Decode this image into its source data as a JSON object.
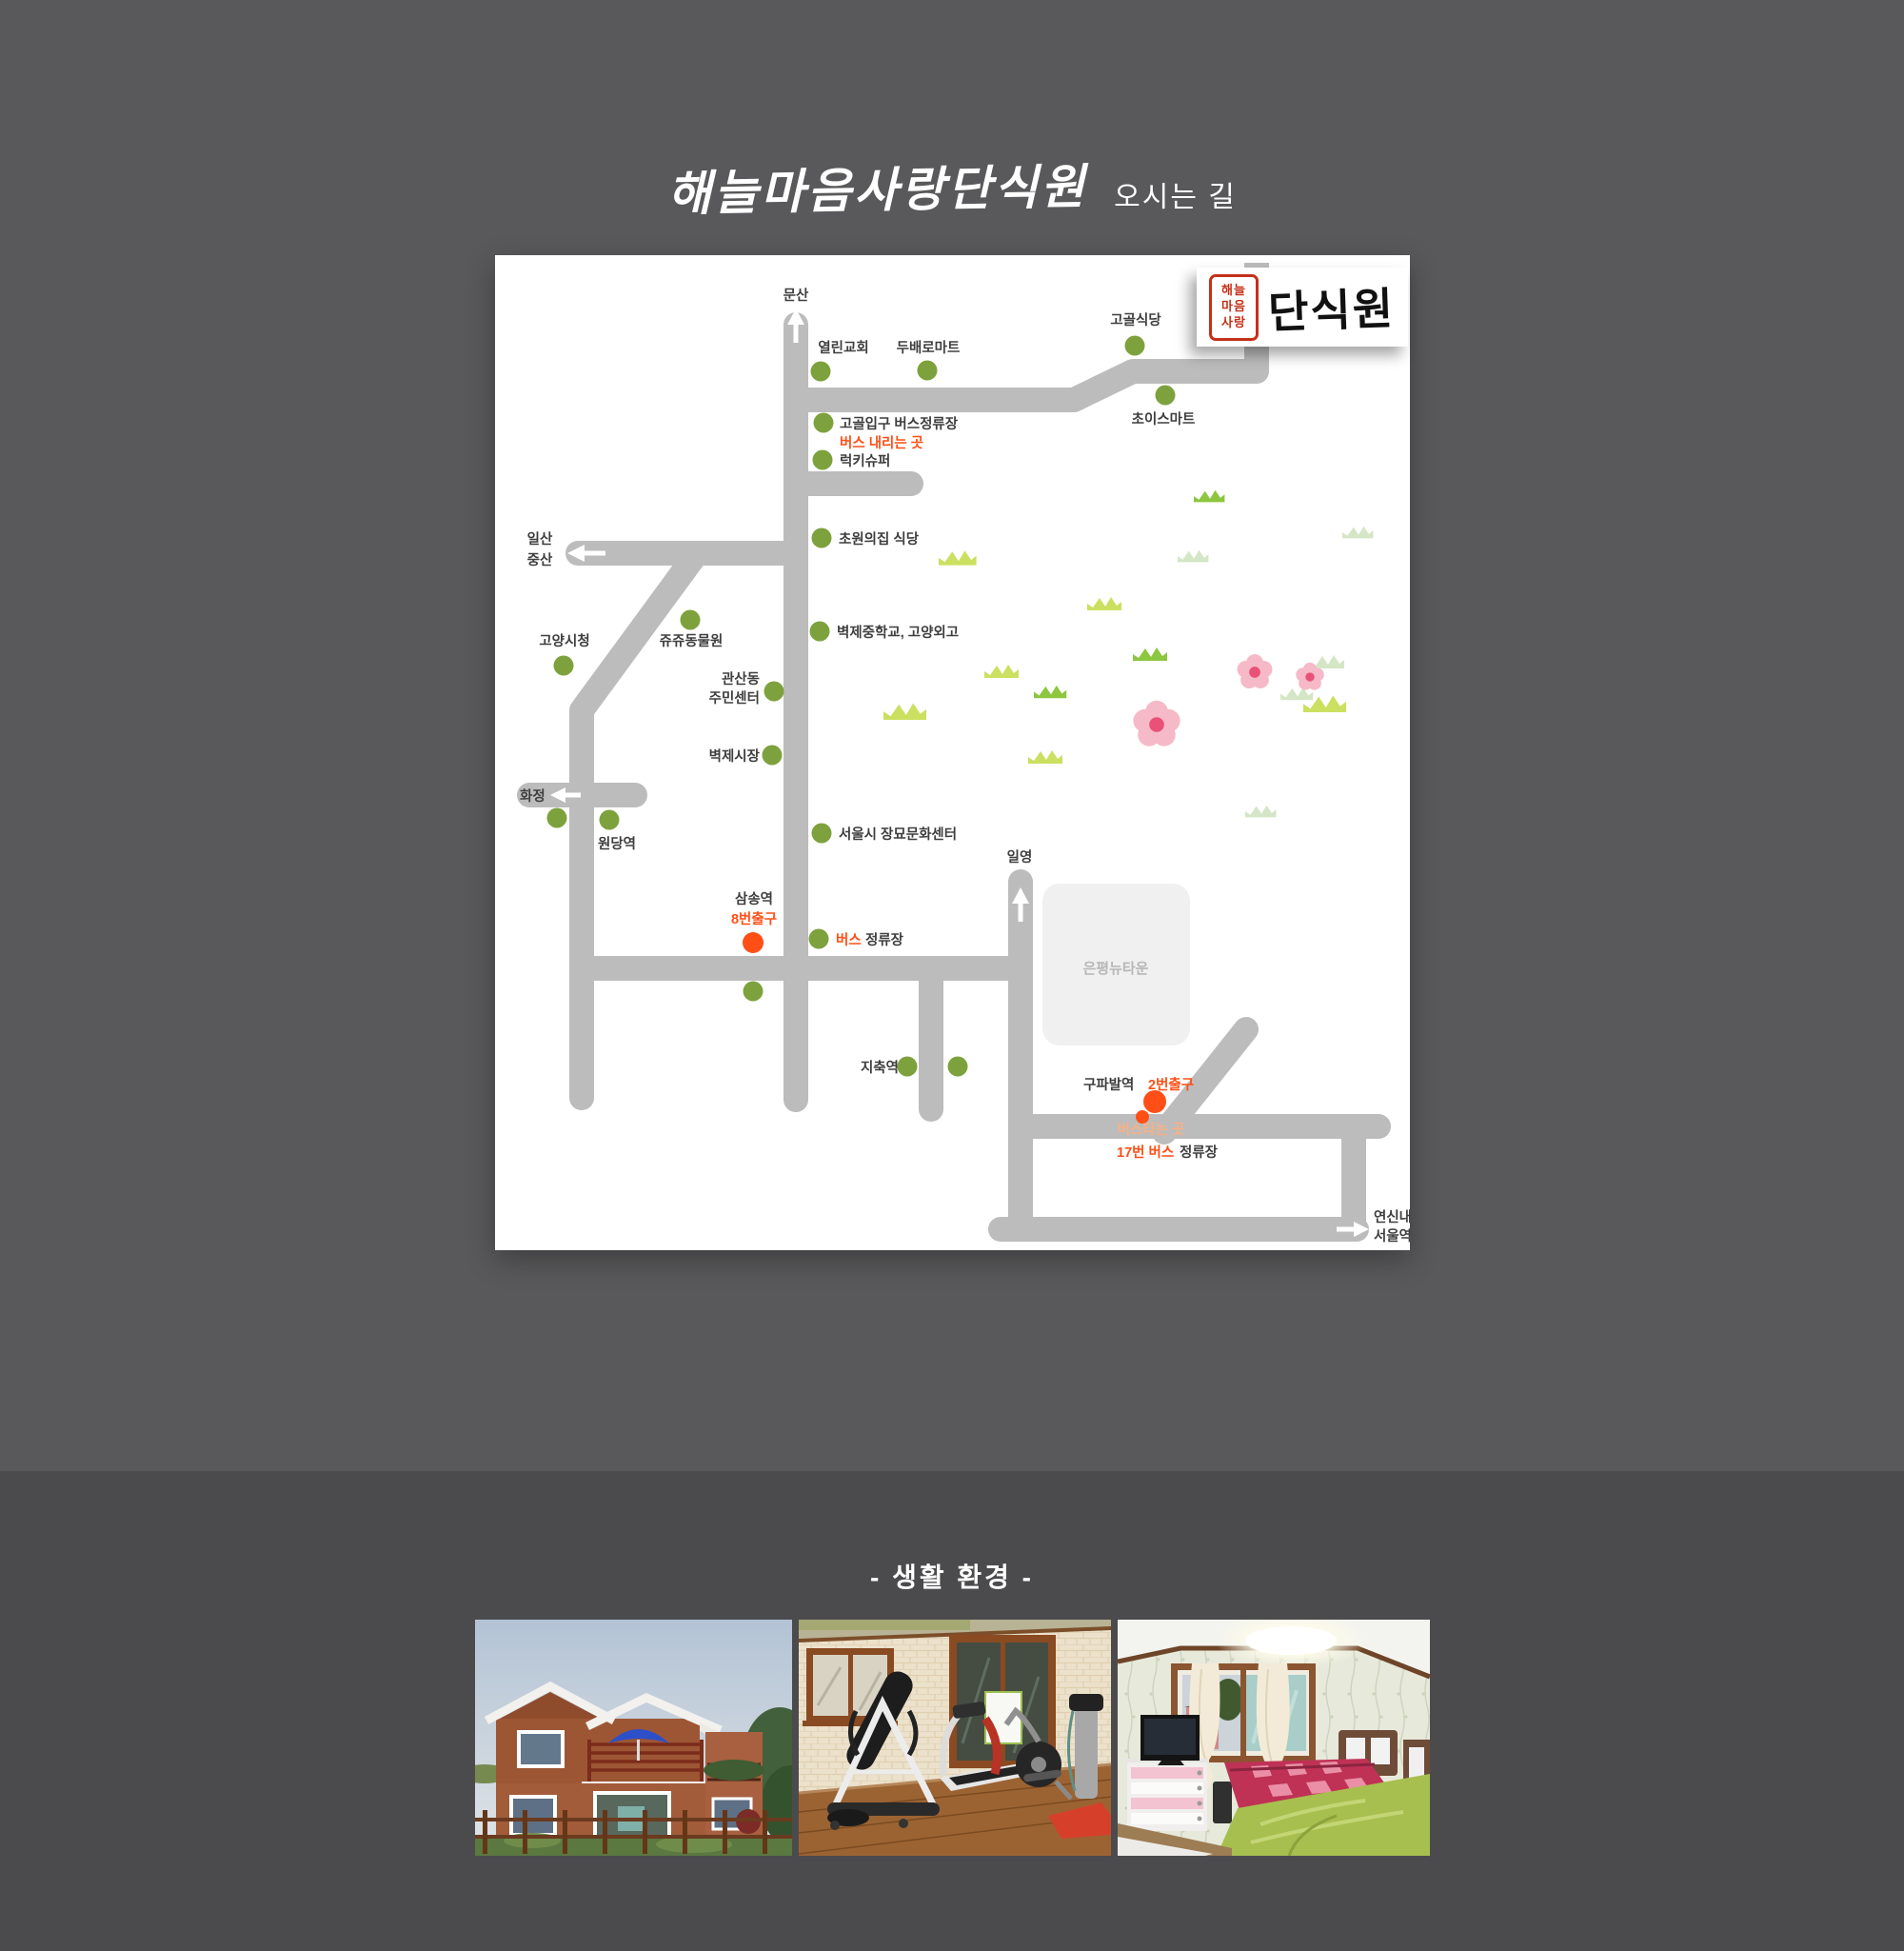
{
  "page": {
    "title": "해늘마음사랑단식원",
    "subtitle": "오시는 길",
    "section_title": "- 생활 환경 -"
  },
  "logo": {
    "seal_line1": "해늘",
    "seal_line2": "마음",
    "seal_line3": "사랑",
    "name": "단식원"
  },
  "map": {
    "labels": {
      "munsan": "문산",
      "yeollin_church": "열린교회",
      "dubae_mart": "두배로마트",
      "gogol_sikdang": "고골식당",
      "choice_mart": "초이스마트",
      "gogol_bus_stop": "고골입구 버스정류장",
      "bus_alight": "버스 내리는 곳",
      "lucky_super": "럭키슈퍼",
      "chowon_sikdang": "초원의집 식당",
      "ilsan": "일산",
      "jungsan": "중산",
      "goyang_cityhall": "고양시청",
      "juju_zoo": "쥬쥬동물원",
      "gwansandong_line1": "관산동",
      "gwansandong_line2": "주민센터",
      "byeokje_school": "벽제중학교, 고양외고",
      "byeokje_market": "벽제시장",
      "hwajeong": "화정",
      "wondang_station": "원당역",
      "jangmyo_center": "서울시 장묘문화센터",
      "samsong_station": "삼송역",
      "samsong_exit": "8번출구",
      "bus_word": "버스",
      "jeongryujang": "정류장",
      "ilyeong": "일영",
      "eunpyeong_newtown": "은평뉴타운",
      "jichuk_station": "지축역",
      "gupabal_station": "구파발역",
      "gupabal_exit": "2번출구",
      "bus_board": "버스타는 곳",
      "bus17": "17번 버스",
      "jeongryujang2": "정류장",
      "yeonsinnae": "연신내",
      "seoul_station": "서울역"
    },
    "colors": {
      "background_top": "#59595b",
      "background_bottom": "#4b4b4d",
      "map_bg": "#ffffff",
      "road": "#bcbcbc",
      "marker_green": "#7da23d",
      "accent_orange": "#ff4f17",
      "soft_orange": "#f9b084",
      "newtown_box": "#f0f0f0",
      "newtown_text": "#b7b7b7",
      "label_text": "#3e3e3e",
      "seal_red": "#c53019"
    },
    "icons": {
      "direction-arrow": "white arrow on road",
      "grass-icon": "green grass tuft",
      "flower-icon": "pink five-petal flower",
      "marker-dot": "round location dot"
    }
  },
  "photos": [
    {
      "name": "building-exterior-photo"
    },
    {
      "name": "exercise-room-photo"
    },
    {
      "name": "bedroom-photo"
    }
  ]
}
